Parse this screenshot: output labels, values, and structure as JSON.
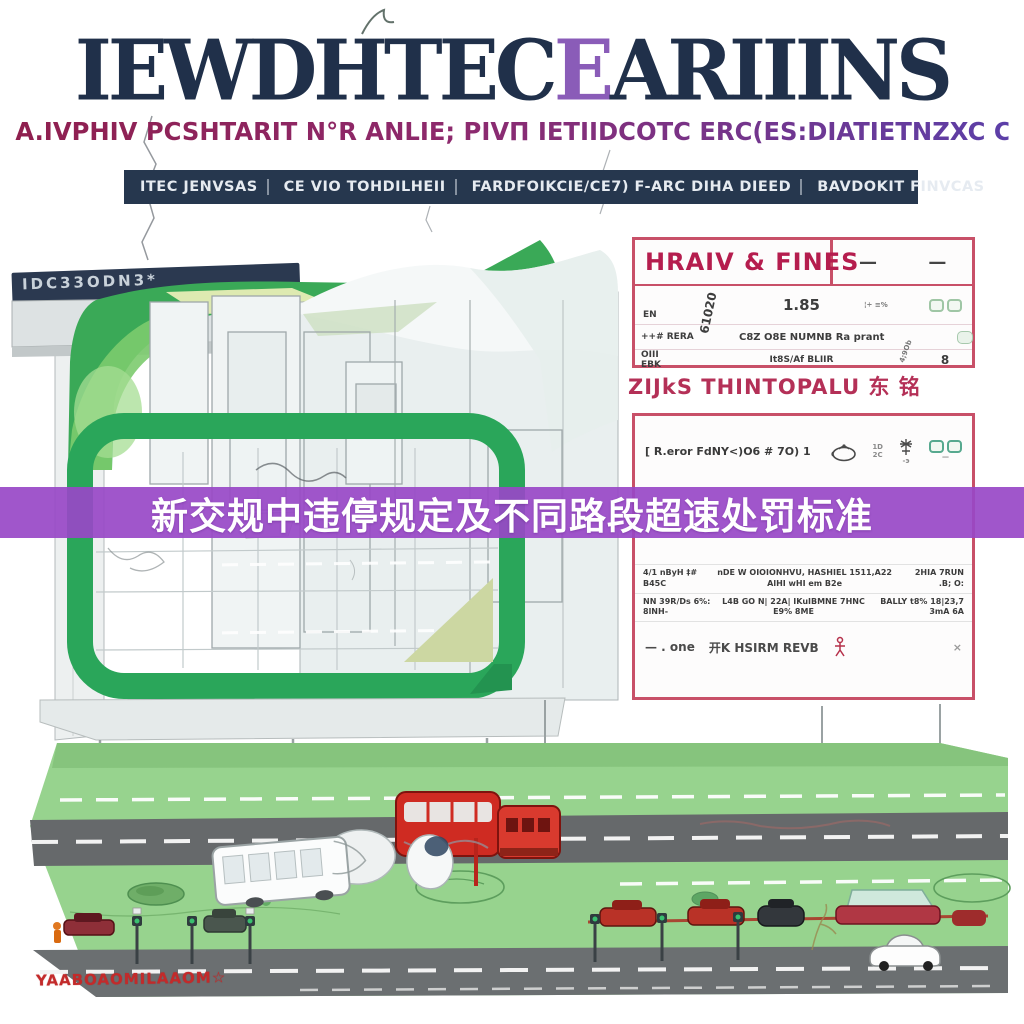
{
  "title": {
    "left": "IEWDHTEC",
    "accent": "E",
    "right": "ARIIINS"
  },
  "subtitle": "A.IVPHIV PCSHTARIT N°R ANLIE; PIVΠ IETIIDCOTC ERC(ES:DIATIETNZXC CTAIRIL'TSI",
  "top_banner": {
    "segments": [
      "ITEC JENVSAS",
      "CE VIO TOHDILHEII",
      "FARDFOIKCIE/CE7) F-ARC DIHA DIEED",
      "BAVDOKIT FINVCAS"
    ]
  },
  "building": {
    "sign_text": "IDC33ODN3*"
  },
  "headline": "新交规中违停规定及不同路段超速处罚标准",
  "colors": {
    "purple_banner": "#9848c7",
    "table_border": "#c85068",
    "header_red": "#b51d4e",
    "title_navy": "#20304a",
    "frame_green": "#2aa65a",
    "platform_green": "#97d38e",
    "road_gray": "#6b6f71",
    "vehicle_red": "#d32f27"
  },
  "fines_table": {
    "header": "HRAIV & FINES",
    "dash_left": "—",
    "dash_right": "—",
    "row1": {
      "c1": "EN",
      "c2": "61020",
      "c3": "1.85",
      "c4": "¦÷ ≡%"
    },
    "row2": {
      "c1": "++# RERA",
      "c2": "C8Z O8E NUMNB Ra prant",
      "c3": "4;9Ob"
    },
    "row3": {
      "c1": "OIII EBK",
      "c2": "It8S/Af BLIIR",
      "c3": "8"
    }
  },
  "caption": "ZIJkS THINTOPALU 东 铭",
  "rules_table": {
    "row1_label": "[ R.eror FdNY<)O6 # 7O) 1",
    "meter_top": "1D",
    "meter_bottom": "2C",
    "tree_sub": "-э",
    "glasses_sub": "—",
    "rowA": {
      "left": "4/1 nByH ‡# B45C",
      "mid": "nDE W OIOIONHVU, HASHIEL 1511,A22 AlHI wHI em B2e",
      "right": "2HIA 7RUN .B; O:"
    },
    "rowB": {
      "left": "NN 39R/Ds 6%: 8lNH-",
      "mid": "L4B GO N| 22A| IKuIBMNE 7HNC E9% 8ME",
      "right": "BALLY t8% 18|23,7 3mA 6A"
    },
    "rowC": {
      "left": "— . one",
      "mid": "开K HSIRM REVB",
      "right": "×"
    }
  },
  "road": {
    "stamp": "YAABOAOMILAAOM☆"
  }
}
